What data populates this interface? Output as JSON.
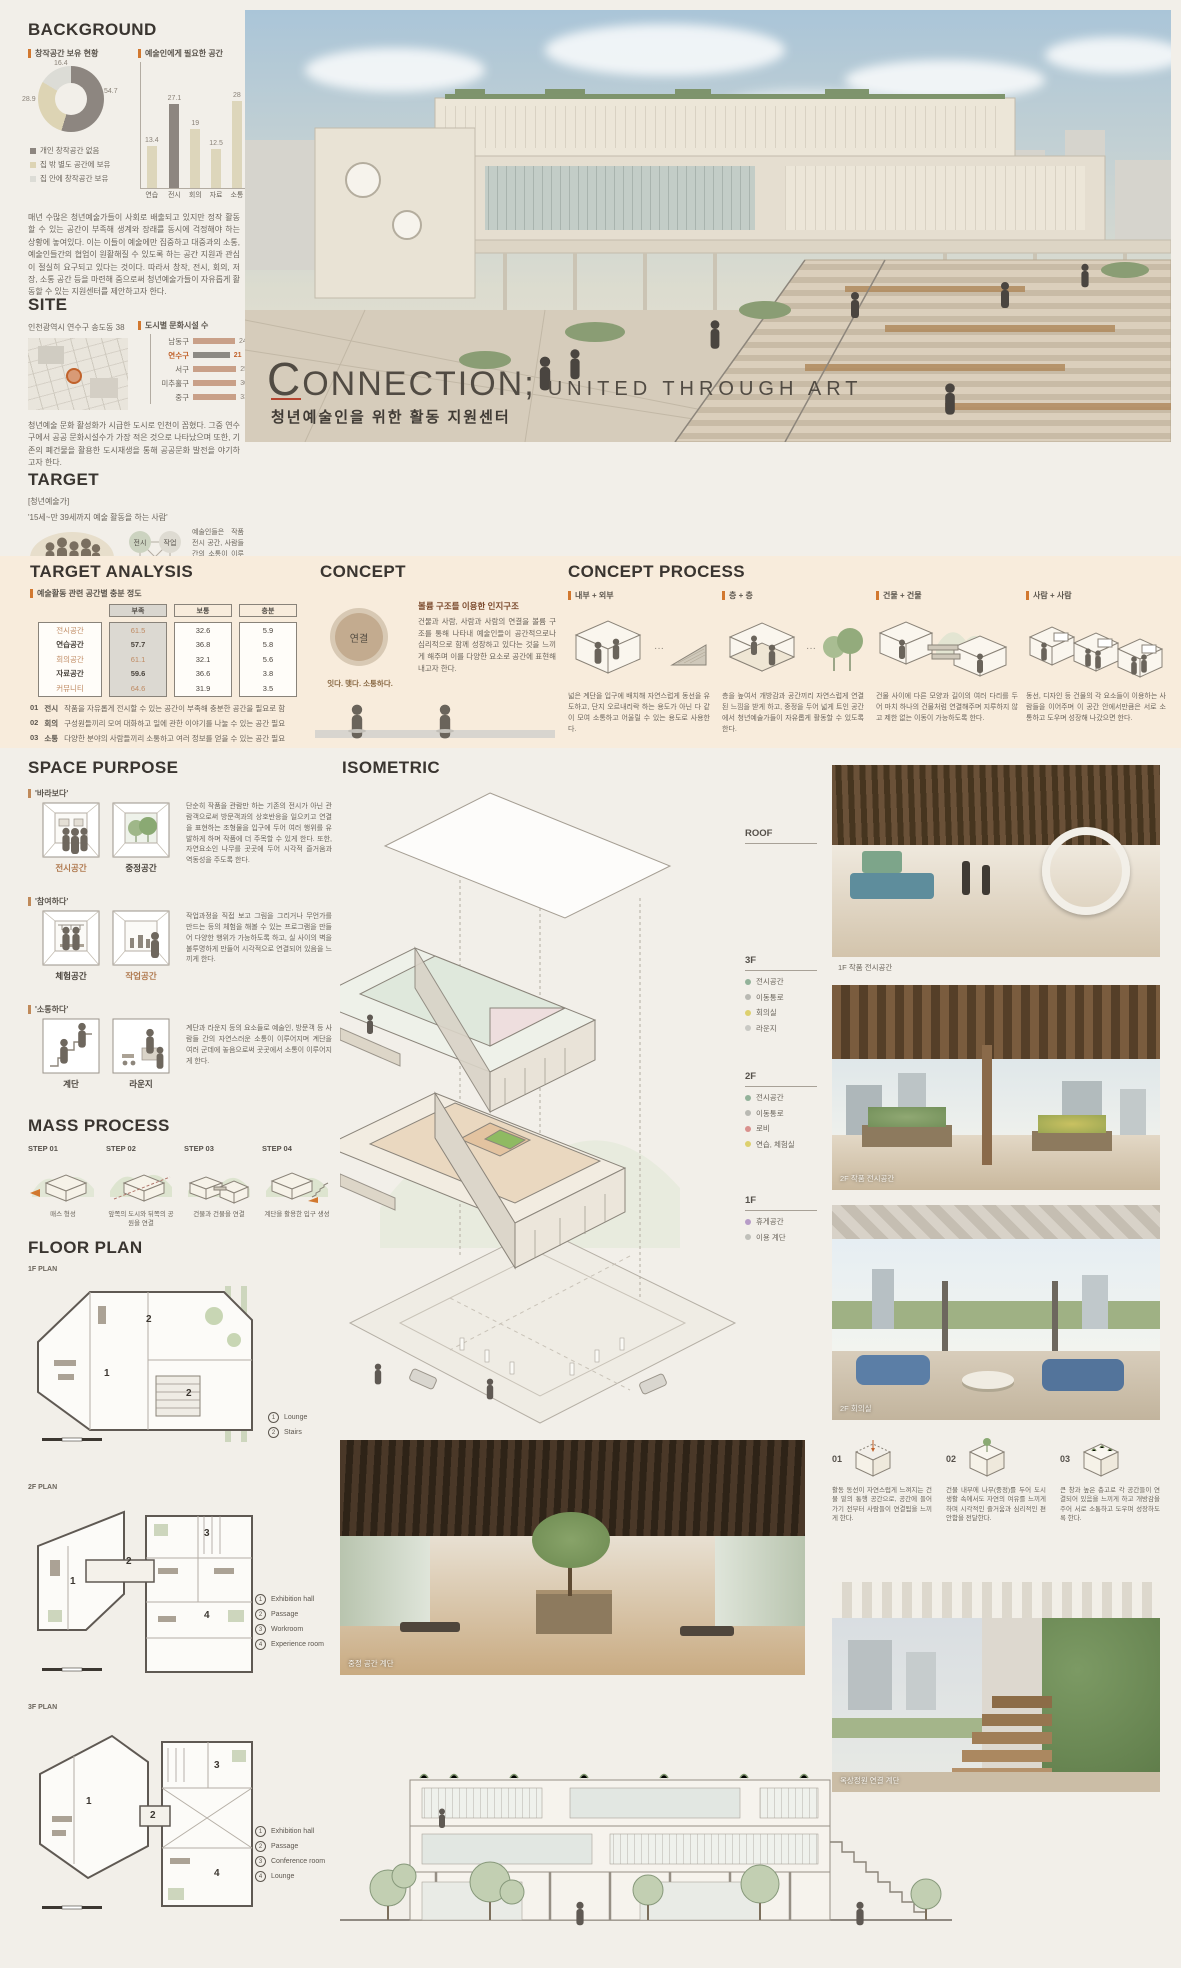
{
  "background": {
    "heading": "BACKGROUND",
    "chart1_label": "창작공간 보유 현황",
    "chart2_label": "예술인에게 필요한 공간",
    "donut": {
      "type": "pie",
      "values": [
        54.7,
        28.9,
        16.4
      ],
      "labels": [
        "개인 창작공간 없음",
        "집 밖 별도 공간에 보유",
        "집 안에 창작공간 보유"
      ],
      "colors": [
        "#8d8680",
        "#ddd4b4",
        "#dcdcd6"
      ]
    },
    "bars": {
      "type": "bar",
      "categories": [
        "연습",
        "전시",
        "회의",
        "자료",
        "소통"
      ],
      "values": [
        13.4,
        27.1,
        19,
        12.5,
        28
      ],
      "highlight_index": 1,
      "bar_color": "#ddd6bb",
      "highlight_color": "#8d8680"
    },
    "body": "매년 수많은 청년예술가들이 사회로 배출되고 있지만 정작 활동할 수 있는 공간이 부족해 생계와 장래를 동시에 걱정해야 하는 상황에 놓여있다. 이는 이들이 예술에만 집중하고 대중과의 소통, 예술인들간의 협업이 원활해질 수 있도록 하는 공간 지원과 관심이 절실히 요구되고 있다는 것이다. 따라서 창작, 전시, 회의, 저장, 소통 공간 등을 마련해 줌으로써 청년예술가들이 자유롭게 활동할 수 있는 지원센터를 제안하고자 한다."
  },
  "site": {
    "heading": "SITE",
    "address": "인천광역시 연수구 송도동 38",
    "chart_label": "도시별 문화시설 수",
    "bars": {
      "type": "bar",
      "categories": [
        "남동구",
        "연수구",
        "서구",
        "미추홀구",
        "중구"
      ],
      "values": [
        24,
        21,
        25,
        30,
        33
      ],
      "highlight_index": 1,
      "bar_color": "#c9a088",
      "highlight_color": "#8d8a84",
      "highlight_text": "#c1622b"
    },
    "body": "청년예술 문화 활성화가 시급한 도시로 인천이 꼽혔다. 그중 연수구에서 공공 문화시설수가 가장 적은 것으로 나타났으며 또한, 기존의 폐건물을 활용한 도시재생을 통해 공공문화 발전을 야기하고자 한다."
  },
  "target": {
    "heading": "TARGET",
    "tag": "[청년예술가]",
    "quote": "'15세~만 39세까지 예술 활동을 하는 사람'",
    "nodes": [
      "전시",
      "작업",
      "회의",
      "소통"
    ],
    "body": "예술인들은 작품 전시 공간, 사람들간의 소통이 이루어지는 공간, 회의실, 작업실, 체험실 등이 구비된 자유로운 분위기 속에서 활동하기를 희망한다."
  },
  "hero": {
    "title": "CONNECTION;",
    "title2": "UNITED THROUGH ART",
    "subtitle": "청년예술인을 위한 활동 지원센터"
  },
  "target_analysis": {
    "heading": "TARGET ANALYSIS",
    "label": "예술활동 관련 공간별 충분 정도",
    "table": {
      "type": "table",
      "columns": [
        "부족",
        "보통",
        "충분"
      ],
      "rows": [
        {
          "label": "전시공간",
          "values": [
            61.5,
            32.6,
            5.9
          ]
        },
        {
          "label": "연습공간",
          "values": [
            57.7,
            36.8,
            5.8
          ]
        },
        {
          "label": "회의공간",
          "values": [
            61.1,
            32.1,
            5.6
          ]
        },
        {
          "label": "자료공간",
          "values": [
            59.6,
            36.6,
            3.8
          ]
        },
        {
          "label": "커뮤니티",
          "values": [
            64.6,
            31.9,
            3.5
          ]
        }
      ]
    },
    "points": [
      {
        "num": "01",
        "kw": "전시",
        "text": "작품을 자유롭게 전시할 수 있는 공간이 부족해 충분한 공간을 필요로 함"
      },
      {
        "num": "02",
        "kw": "회의",
        "text": "구성원들끼리 모여 대화하고 일에 관한 이야기를 나눌 수 있는 공간 필요"
      },
      {
        "num": "03",
        "kw": "소통",
        "text": "다양한 분야의 사람들끼리 소통하고 여러 정보를 얻을 수 있는 공간 필요"
      }
    ]
  },
  "concept": {
    "heading": "CONCEPT",
    "circle": "연결",
    "circle_caption": "잇다. 맺다. 소통하다.",
    "sub_title": "볼륨 구조를 이용한 인지구조",
    "body": "건물과 사람, 사람과 사람의 연결을 볼륨 구조를 통해 나타내 예술인들이 공간적으로나 심리적으로 함께 성장하고 있다는 것을 느끼게 해주며 이를 다양한 요소로 공간에 표현해 내고자 한다."
  },
  "concept_process": {
    "heading": "CONCEPT PROCESS",
    "dots": "···",
    "items": [
      {
        "label": "내부 + 외부",
        "text": "넓은 계단을 입구에 배치해 자연스럽게 동선을 유도하고, 단지 오르내리락 하는 용도가 아닌 다 같이 모여 소통하고 어울릴 수 있는 용도로 사용한다."
      },
      {
        "label": "층 + 층",
        "text": "층을 높여서 개방감과 공간끼리 자연스럽게 연결된 느낌을 받게 하고, 중정을 두어 넓게 트인 공간에서 청년예술가들이 자유롭게 활동할 수 있도록 한다."
      },
      {
        "label": "건물 + 건물",
        "text": "건물 사이에 다른 모양과 길이의 여러 다리를 두어 마치 하나의 건물처럼 연결해주며 지루하지 않고 제한 없는 이동이 가능하도록 한다."
      },
      {
        "label": "사람 + 사람",
        "text": "동선, 디자인 등 건물의 각 요소들이 이용하는 사람들을 이어주며 이 공간 안에서만큼은 서로 소통하고 도우며 성장해 나갔으면 한다."
      }
    ]
  },
  "space_purpose": {
    "heading": "SPACE PURPOSE",
    "blocks": [
      {
        "tag": "'바라보다'",
        "rooms": [
          "전시공간",
          "중정공간"
        ],
        "text": "단순히 작품을 관람만 하는 기존의 전시가 아닌 관람객으로써 방문객과의 상호반응을 일으키고 연결을 표현하는 조형물을 입구에 두어 여러 행위를 유발하게 하며 작품에 더 주목할 수 있게 한다. 또한, 자연요소인 나무를 곳곳에 두어 시각적 즐거움과 역동성을 주도록 한다."
      },
      {
        "tag": "'참여하다'",
        "rooms": [
          "체험공간",
          "작업공간"
        ],
        "text": "작업과정을 직접 보고 그림을 그리거나 무언가를 만드는 등의 체험을 해볼 수 있는 프로그램을 만들어 다양한 행위가 가능하도록 하고, 실 사이의 벽을 불투명하게 만들어 시각적으로 연결되어 있음을 느끼게 한다."
      },
      {
        "tag": "'소통하다'",
        "rooms": [
          "계단",
          "라운지"
        ],
        "text": "계단과 라운지 등의 요소들로 예술인, 방문객 등 사람들 간의 자연스러운 소통이 이루어지며 계단을 여러 군데에 놓음으로써 곳곳에서 소통이 이루어지게 한다."
      }
    ]
  },
  "mass_process": {
    "heading": "MASS PROCESS",
    "steps": [
      {
        "step": "STEP 01",
        "caption": "매스 형성"
      },
      {
        "step": "STEP 02",
        "caption": "앞쪽의 도시와 뒤쪽의 공원을 연결"
      },
      {
        "step": "STEP 03",
        "caption": "건물과 건물을 연결"
      },
      {
        "step": "STEP 04",
        "caption": "계단을 활용한 입구 생성"
      }
    ]
  },
  "floor_plan": {
    "heading": "FLOOR PLAN",
    "plans": [
      {
        "label": "1F PLAN",
        "marks": [
          "1",
          "2",
          "2"
        ],
        "legend": [
          {
            "num": "1",
            "label": "Lounge"
          },
          {
            "num": "2",
            "label": "Stairs"
          }
        ]
      },
      {
        "label": "2F PLAN",
        "marks": [
          "1",
          "2",
          "3",
          "4"
        ],
        "legend": [
          {
            "num": "1",
            "label": "Exhibition hall"
          },
          {
            "num": "2",
            "label": "Passage"
          },
          {
            "num": "3",
            "label": "Workroom"
          },
          {
            "num": "4",
            "label": "Experience room"
          }
        ]
      },
      {
        "label": "3F PLAN",
        "marks": [
          "1",
          "2",
          "3",
          "4"
        ],
        "legend": [
          {
            "num": "1",
            "label": "Exhibition hall"
          },
          {
            "num": "2",
            "label": "Passage"
          },
          {
            "num": "3",
            "label": "Conference room"
          },
          {
            "num": "4",
            "label": "Lounge"
          }
        ]
      }
    ]
  },
  "isometric": {
    "heading": "ISOMETRIC",
    "floors": [
      {
        "label": "ROOF",
        "items": []
      },
      {
        "label": "3F",
        "items": [
          {
            "label": "전시공간",
            "color": "#93b29a"
          },
          {
            "label": "이동통로",
            "color": "#b9b9b3"
          },
          {
            "label": "회의실",
            "color": "#ddd06e"
          },
          {
            "label": "라운지",
            "color": "#c9c9c4"
          }
        ]
      },
      {
        "label": "2F",
        "items": [
          {
            "label": "전시공간",
            "color": "#93b29a"
          },
          {
            "label": "이동통로",
            "color": "#b9b9b3"
          },
          {
            "label": "로비",
            "color": "#d9908d"
          },
          {
            "label": "연습, 체험실",
            "color": "#ddd06e"
          }
        ]
      },
      {
        "label": "1F",
        "items": [
          {
            "label": "휴게공간",
            "color": "#b79cc7"
          },
          {
            "label": "이용 계단",
            "color": "#c0c0ba"
          }
        ]
      }
    ]
  },
  "gallery": {
    "img1_caption": "1F 작품 전시공간",
    "img2_caption": "2F 작품 전시공간",
    "img3_caption": "2F 회의실",
    "img4_caption": "옥상정원 연결 계단",
    "center_caption": "중정 공간 계단"
  },
  "idea_row": {
    "items": [
      {
        "num": "01",
        "text": "활동 동선이 자연스럽게 느껴지는 건물 밑의 통행 공간으로, 공간에 들어가기 전부터 사람들이 연결됨을 느끼게 한다."
      },
      {
        "num": "02",
        "text": "건물 내부에 나무(중정)를 두어 도시 생활 속에서도 자연의 여유를 느끼게 하며 시각적인 즐거움과 심리적인 편안함을 전달한다."
      },
      {
        "num": "03",
        "text": "큰 창과 높은 층고로 각 공간들이 연결되어 있음을 느끼게 하고 개방감을 주어 서로 소통하고 도우며 성장하도록 한다."
      }
    ]
  }
}
